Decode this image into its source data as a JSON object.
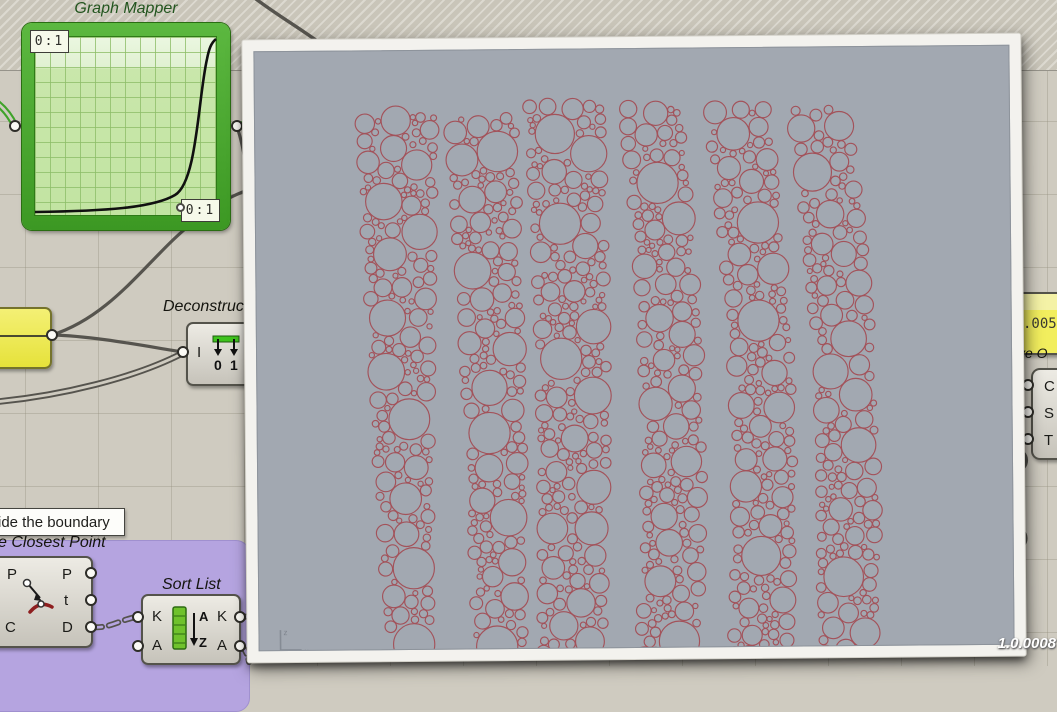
{
  "graph_mapper": {
    "title": "Graph Mapper",
    "top_left_label": "0:1",
    "bottom_right_label": "0:1"
  },
  "deconstruct": {
    "title": "Deconstruct",
    "input_label": "I",
    "icon_digit_0": "0",
    "icon_digit_1": "1"
  },
  "sort_list": {
    "title": "Sort List",
    "inputs": [
      "K",
      "A"
    ],
    "outputs": [
      "K",
      "A"
    ],
    "icon_top": "A",
    "icon_bottom": "Z"
  },
  "closest_point": {
    "title": "e Closest Point",
    "inputs": [
      "P",
      "C"
    ],
    "outputs": [
      "P",
      "t",
      "D"
    ]
  },
  "tooltip": {
    "text": "ide the boundary"
  },
  "panel_right": {
    "value": ".005"
  },
  "offset_label": {
    "text": "ve O"
  },
  "cst_component": {
    "inputs": [
      "C",
      "S",
      "T"
    ]
  },
  "version_badge": {
    "text": "1.0.0008"
  },
  "viewport": {
    "bg": "#a2a8b1",
    "circle_color": "#a3525a",
    "axis": {
      "v": "z",
      "h": "x"
    },
    "packing": {
      "seed": 7,
      "radius_min": 2.5,
      "radius_max": 21,
      "columns": [
        {
          "xt": 142,
          "xm": 143,
          "xb": 150,
          "wt": 80,
          "wb": 46,
          "yt": 66,
          "yb": 612
        },
        {
          "xt": 226,
          "xm": 240,
          "xb": 240,
          "wt": 72,
          "wb": 52,
          "yt": 68,
          "yb": 612
        },
        {
          "xt": 309,
          "xm": 321,
          "xb": 312,
          "wt": 78,
          "wb": 66,
          "yt": 56,
          "yb": 612
        },
        {
          "xt": 395,
          "xm": 428,
          "xb": 408,
          "wt": 62,
          "wb": 64,
          "yt": 60,
          "yb": 612
        },
        {
          "xt": 481,
          "xm": 518,
          "xb": 500,
          "wt": 66,
          "wb": 62,
          "yt": 58,
          "yb": 612
        },
        {
          "xt": 563,
          "xm": 602,
          "xb": 586,
          "wt": 62,
          "wb": 62,
          "yt": 62,
          "yb": 612
        }
      ]
    }
  }
}
